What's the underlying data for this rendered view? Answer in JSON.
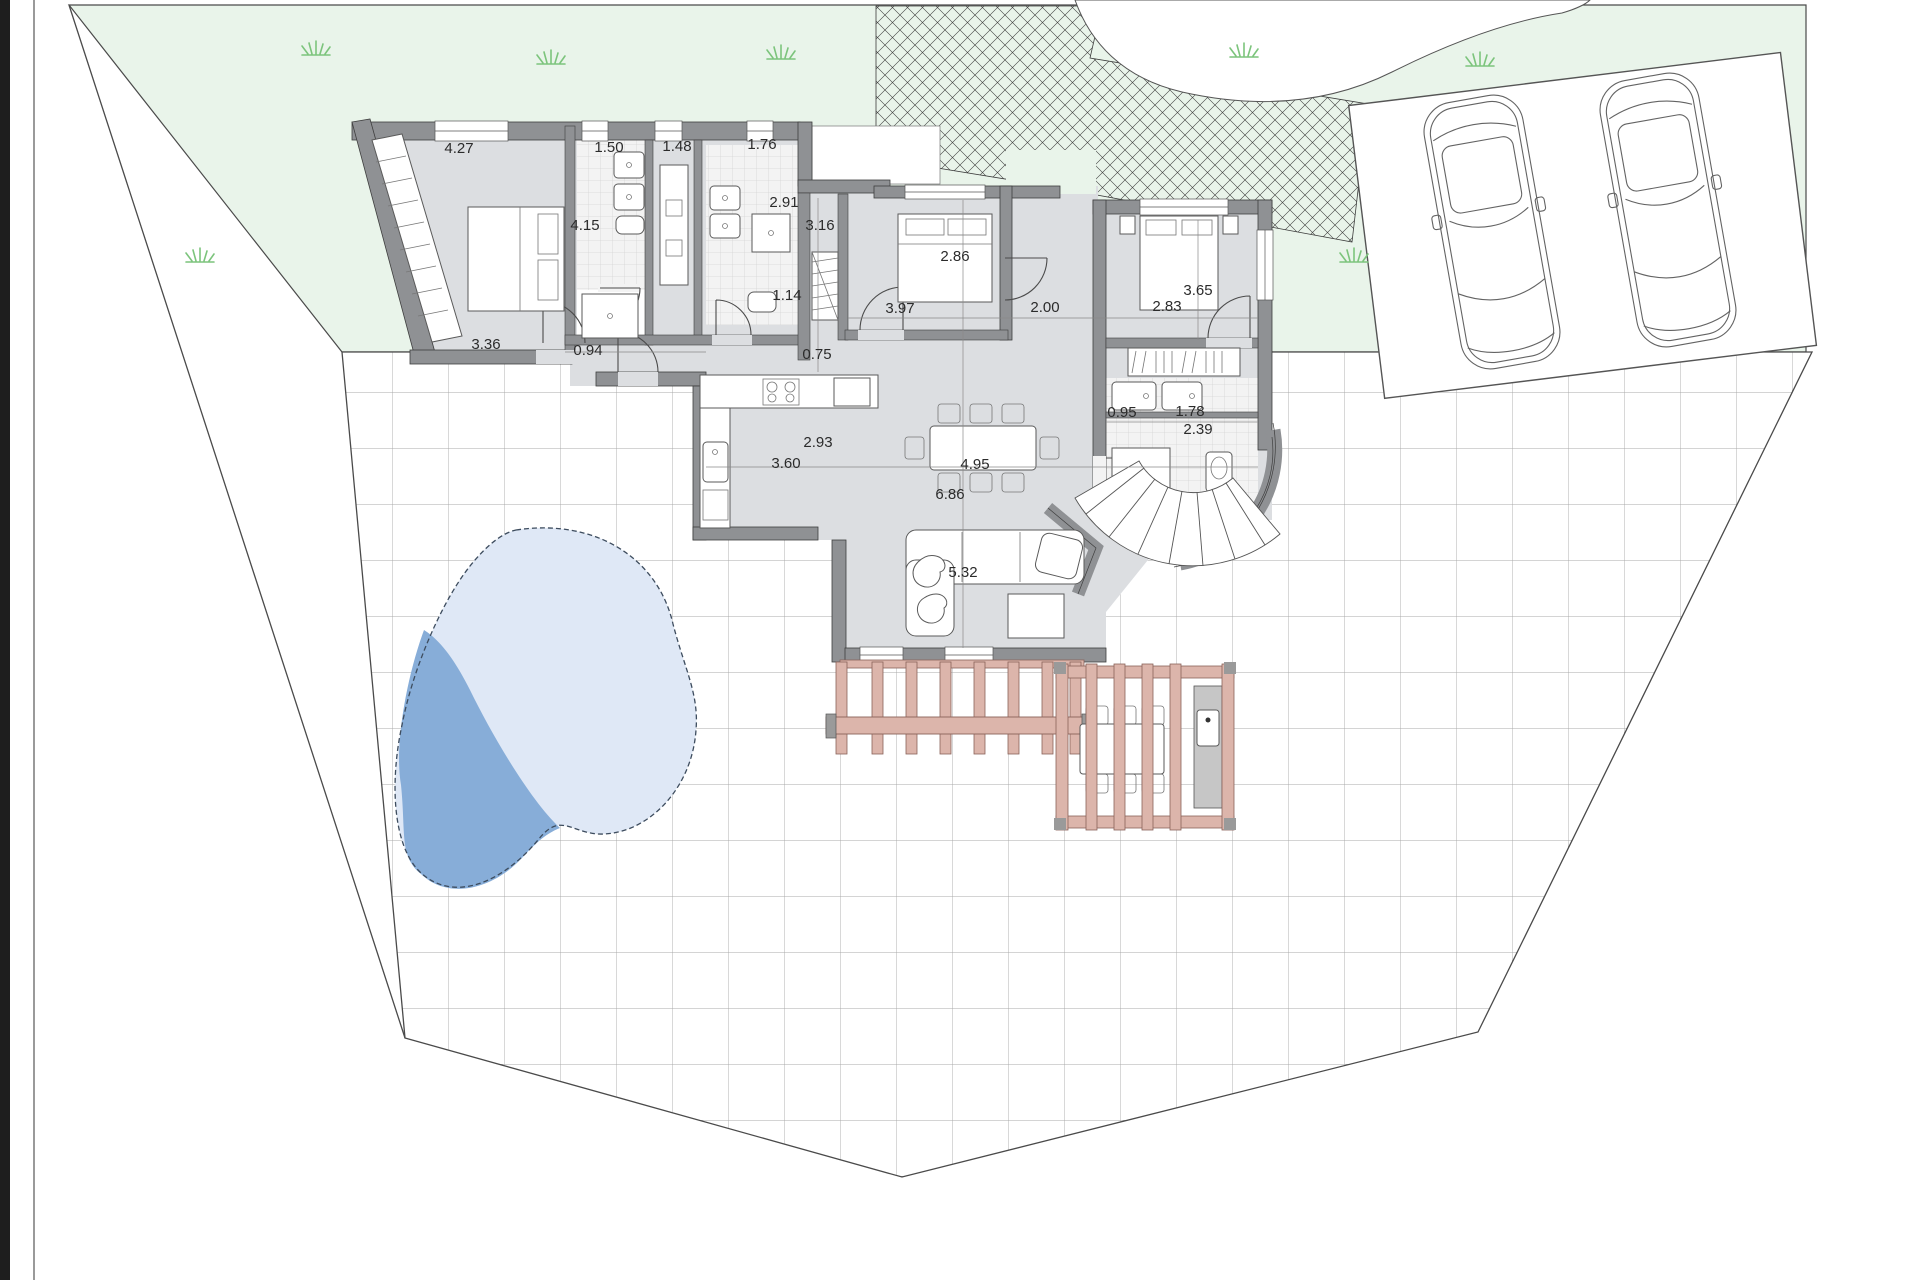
{
  "title": "Villa ground floor site plan",
  "floor_plan": {
    "dimension_labels": [
      {
        "value": "4.27",
        "x": 459,
        "y": 153
      },
      {
        "value": "1.50",
        "x": 609,
        "y": 152
      },
      {
        "value": "1.48",
        "x": 677,
        "y": 151
      },
      {
        "value": "1.76",
        "x": 762,
        "y": 149
      },
      {
        "value": "4.15",
        "x": 585,
        "y": 230
      },
      {
        "value": "2.91",
        "x": 784,
        "y": 207
      },
      {
        "value": "3.16",
        "x": 820,
        "y": 230
      },
      {
        "value": "2.86",
        "x": 955,
        "y": 261
      },
      {
        "value": "1.14",
        "x": 787,
        "y": 300
      },
      {
        "value": "3.97",
        "x": 900,
        "y": 313
      },
      {
        "value": "2.00",
        "x": 1045,
        "y": 312
      },
      {
        "value": "2.83",
        "x": 1167,
        "y": 311
      },
      {
        "value": "3.65",
        "x": 1198,
        "y": 295
      },
      {
        "value": "3.36",
        "x": 486,
        "y": 349
      },
      {
        "value": "0.94",
        "x": 588,
        "y": 355
      },
      {
        "value": "0.75",
        "x": 817,
        "y": 359
      },
      {
        "value": "2.93",
        "x": 818,
        "y": 447
      },
      {
        "value": "3.60",
        "x": 786,
        "y": 468
      },
      {
        "value": "4.95",
        "x": 975,
        "y": 469
      },
      {
        "value": "6.86",
        "x": 950,
        "y": 499
      },
      {
        "value": "0.95",
        "x": 1122,
        "y": 417
      },
      {
        "value": "1.78",
        "x": 1190,
        "y": 416
      },
      {
        "value": "2.39",
        "x": 1198,
        "y": 434
      },
      {
        "value": "5.32",
        "x": 963,
        "y": 577
      }
    ],
    "features": {
      "garden": "lawn-area",
      "driveway": "paved-driveway-hatch",
      "carport": "carport-two-cars",
      "patio": "tiled-terrace",
      "pool": "swimming-pool",
      "pergola_left": "pergola",
      "pergola_right": "pergola-outdoor-kitchen",
      "stairs": "curved-exterior-stairs"
    },
    "colors": {
      "lawn": "#e9f4ea",
      "grass_tuft": "#7cc47c",
      "interior_floor": "#dcdee1",
      "wall": "#8f9194",
      "tile_grid": "#a9a9a9",
      "pool_light": "#dfe8f6",
      "pool_dark": "#87add8",
      "pergola": "#dcb5ab",
      "chrome_bar": "#1e1e1e"
    }
  }
}
